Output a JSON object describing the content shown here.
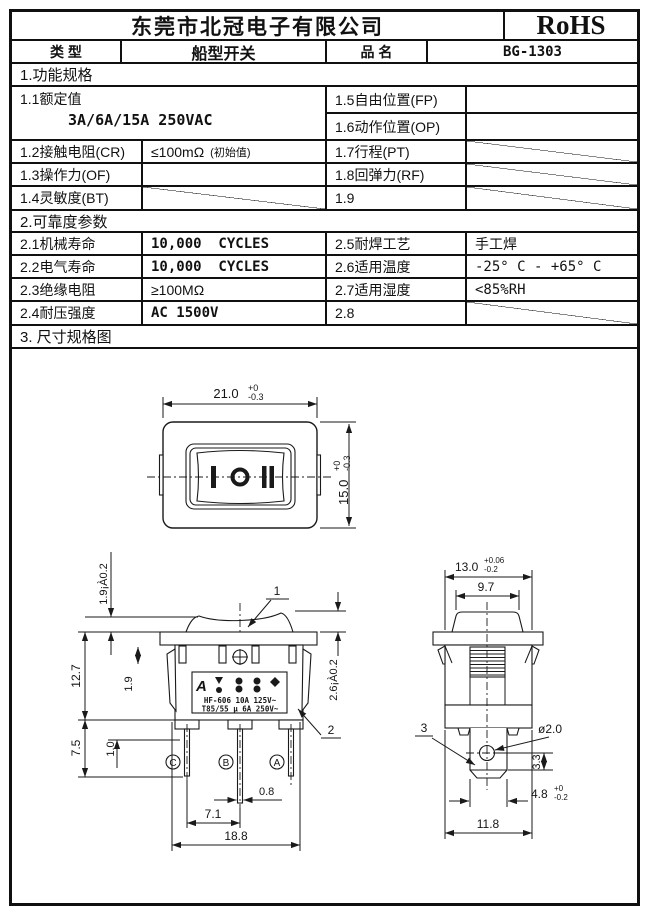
{
  "colors": {
    "ink": "#101010",
    "paper": "#ffffff"
  },
  "header": {
    "company": "东莞市北冠电子有限公司",
    "rohs": "RoHS",
    "type_label": "类 型",
    "type_value": "船型开关",
    "name_label": "品 名",
    "name_value": "BG-1303"
  },
  "sections": {
    "s1": "1.功能规格",
    "s2": "2.可靠度参数",
    "s3": "3. 尺寸规格图"
  },
  "spec1": {
    "r11_label": "1.1额定值",
    "r11_value": "3A/6A/15A   250VAC",
    "r15_label": "1.5自由位置(FP)",
    "r16_label": "1.6动作位置(OP)",
    "r12_label": "1.2接触电阻(CR)",
    "r12_value": "≤100mΩ",
    "r12_note": "(初始值)",
    "r17_label": "1.7行程(PT)",
    "r13_label": "1.3操作力(OF)",
    "r18_label": "1.8回弹力(RF)",
    "r14_label": "1.4灵敏度(BT)",
    "r19_label": "1.9"
  },
  "spec2": {
    "r21_label": "2.1机械寿命",
    "r21_value": "10,000  CYCLES",
    "r25_label": "2.5耐焊工艺",
    "r25_value": "手工焊",
    "r22_label": "2.2电气寿命",
    "r22_value": "10,000  CYCLES",
    "r26_label": "2.6适用温度",
    "r26_value": "-25° C - +65° C",
    "r23_label": "2.3绝缘电阻",
    "r23_value": "≥100MΩ",
    "r27_label": "2.7适用湿度",
    "r27_value": "<85%RH",
    "r24_label": "2.4耐压强度",
    "r24_value": "AC 1500V",
    "r28_label": "2.8"
  },
  "drawing": {
    "front": {
      "w_main": "21.0",
      "w_plus": "+0",
      "w_minus": "-0.3",
      "h_main": "15.0",
      "h_plus": "+0",
      "h_minus": "-0.3"
    },
    "bleft": {
      "protrusion": "1.9¡À0.2",
      "rocker_h": "2.6¡À0.2",
      "flange_gap": "1.9",
      "body_h": "12.7",
      "pin_h": "7.5",
      "tab_h": "1.0",
      "pin_w": "0.8",
      "pin_pitch": "7.1",
      "body_w": "18.8",
      "callout1": "1",
      "callout2": "2",
      "pinC": "C",
      "pinB": "B",
      "pinA": "A",
      "logo": "A",
      "mark1": "HF-606 10A 125V~",
      "mark2": "T85/55 µ 6A 250V~"
    },
    "bright": {
      "w_main": "13.0",
      "w_plus": "+0.06",
      "w_minus": "-0.2",
      "knob_w": "9.7",
      "hole": "ø2.0",
      "hole_off": "3.3",
      "latch_main": "4.8",
      "latch_plus": "+0",
      "latch_minus": "-0.2",
      "base_w": "11.8",
      "callout3": "3"
    }
  }
}
